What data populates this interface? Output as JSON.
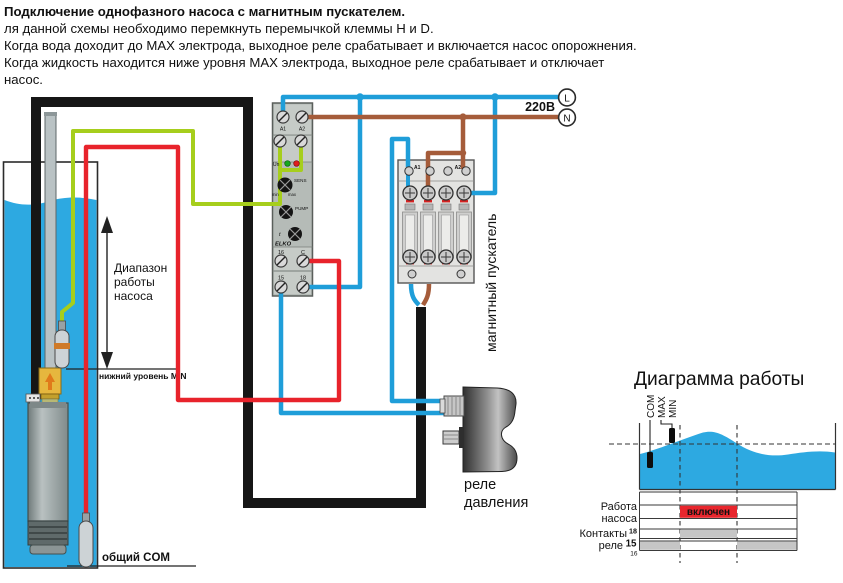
{
  "header": {
    "lines": [
      "Подключение однофазного насоса с магнитным пускателем.",
      "ля данной схемы необходимо перемкнуть перемычкой клеммы H и D.",
      "Когда вода доходит до MAX электрода, выходное реле срабатывает и включается насос опорожнения.",
      "Когда жидкость находится ниже уровня MAX электрода, выходное реле срабатывает и отключает",
      "насос."
    ]
  },
  "power": {
    "voltage": "220В",
    "line": "L",
    "neutral": "N"
  },
  "well": {
    "range_line1": "Диапазон",
    "range_line2": "работы",
    "range_line3": "насоса",
    "min_level_label": "нижний уровень MIN",
    "com_label": "общий COM"
  },
  "level_relay": {
    "terminal_a1": "A1",
    "terminal_a2": "A2",
    "led_label": "Un",
    "sens_label": "SENS",
    "sens_min": "min",
    "sens_max": "max",
    "pump_label": "PUMP",
    "time_label": "t",
    "brand": "ELKO",
    "terminal_16": "16",
    "terminal_c": "C",
    "terminal_15": "15",
    "terminal_18": "18"
  },
  "contactor": {
    "label": "магнитный пускатель",
    "terminal_a1": "A1",
    "terminal_a2": "A2"
  },
  "pressure_switch": {
    "label_line1": "реле",
    "label_line2": "давления"
  },
  "work_diagram": {
    "title": "Диаграмма работы",
    "electrode_com": "COM",
    "electrode_max": "MAX",
    "electrode_min": "MIN",
    "pump_label_line1": "Работа",
    "pump_label_line2": "насоса",
    "on_badge": "включен",
    "contacts_label_line1": "Контакты",
    "contacts_label_line2": "реле",
    "contact_18": "18",
    "contact_15": "15",
    "contact_16": "16"
  },
  "colors": {
    "wire_blue": "#1f9ed9",
    "wire_red": "#e8232b",
    "wire_green": "#a6ce1c",
    "wire_brown": "#a55c3a",
    "wire_black": "#161616",
    "water": "#2da9e1",
    "on_badge_bg": "#e8262d"
  }
}
